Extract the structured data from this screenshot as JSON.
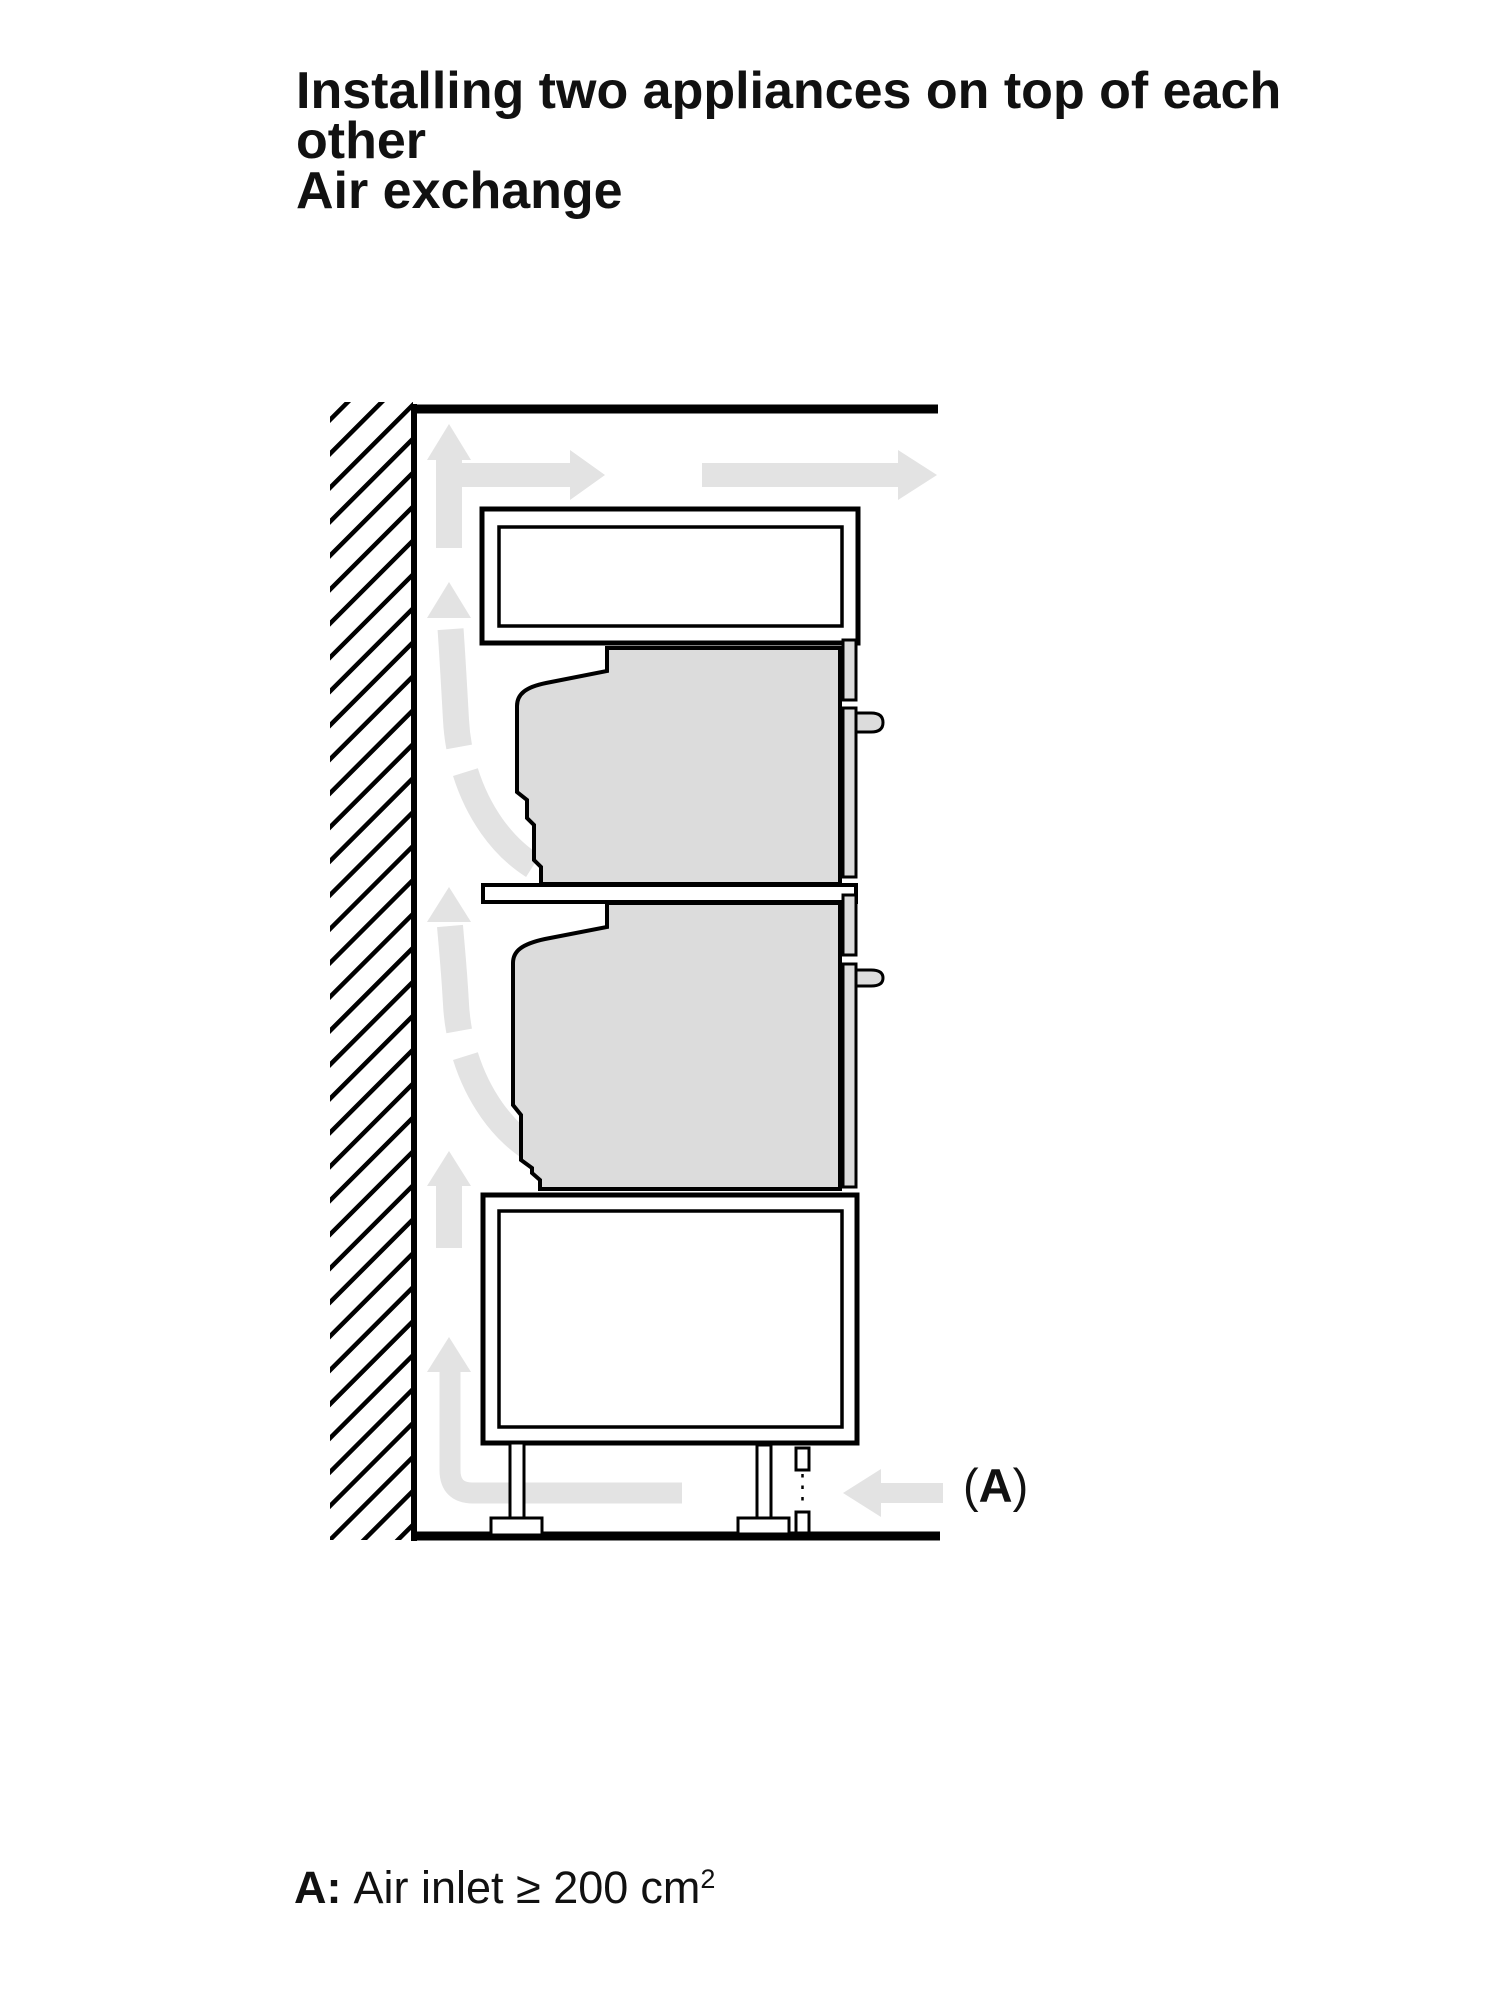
{
  "title": {
    "lines": [
      "Installing two appliances on top of each",
      "other",
      "Air exchange"
    ]
  },
  "diagram": {
    "label_a": {
      "open": "(",
      "letter": "A",
      "close": ")"
    },
    "colors": {
      "outline": "#000000",
      "appliance_fill": "#dcdcdc",
      "airflow_fill": "#e3e3e3",
      "interior_fill": "#ffffff",
      "text": "#111111"
    }
  },
  "caption": {
    "label": "A:",
    "text": "Air inlet ≥ 200",
    "unit": "cm",
    "superscript": "2"
  }
}
